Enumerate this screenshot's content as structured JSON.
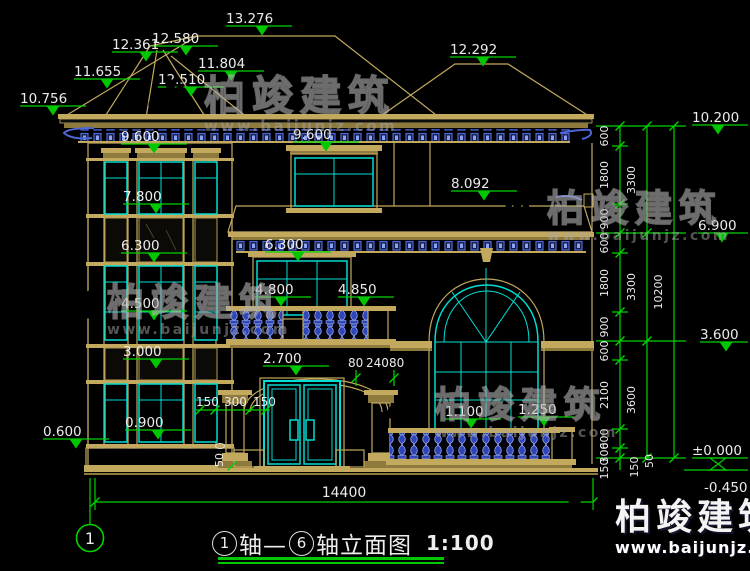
{
  "page": {
    "title": {
      "axis_start": "1",
      "seg1": "轴—",
      "axis_end": "6",
      "seg2": "轴立面图",
      "scale": "1:100"
    },
    "axis_bubble": "1",
    "watermark": {
      "brand": "柏竣建筑",
      "site": "www.baijunjz.com"
    },
    "elevations": {
      "roof": [
        "13.276",
        "12.580",
        "12.361",
        "11.804",
        "12.510",
        "11.655",
        "10.756",
        "12.292"
      ],
      "tower": [
        "9.600",
        "7.800",
        "6.300",
        "4.500",
        "3.000",
        "0.900"
      ],
      "left_base": "0.600",
      "center": {
        "f3": "9.600",
        "band": "8.092",
        "f2": "6.300",
        "balcony_l": "4.800",
        "balcony_r": "4.850",
        "arch": "2.700",
        "porch_rail": "1.100",
        "porch_post": "1.250"
      },
      "right": [
        "10.200",
        "6.900",
        "3.600",
        "±0.000",
        "-0.450"
      ]
    },
    "dims": {
      "total_width": "14400",
      "right_col1": [
        "600",
        "1800",
        "900",
        "600",
        "1800",
        "900",
        "600",
        "2100",
        "600",
        "300",
        "150"
      ],
      "right_col2": [
        "3300",
        "3300",
        "3600",
        "150",
        "50"
      ],
      "right_col3": "10200",
      "door_left": [
        "150",
        "300",
        "150"
      ],
      "door_right": [
        "80",
        "240",
        "80"
      ],
      "step": "50"
    },
    "colors": {
      "line_tan": "#c2a95e",
      "dim_green": "#00d400",
      "glass_cyan": "#00ded2",
      "detail_blue": "#4e66d6"
    }
  }
}
